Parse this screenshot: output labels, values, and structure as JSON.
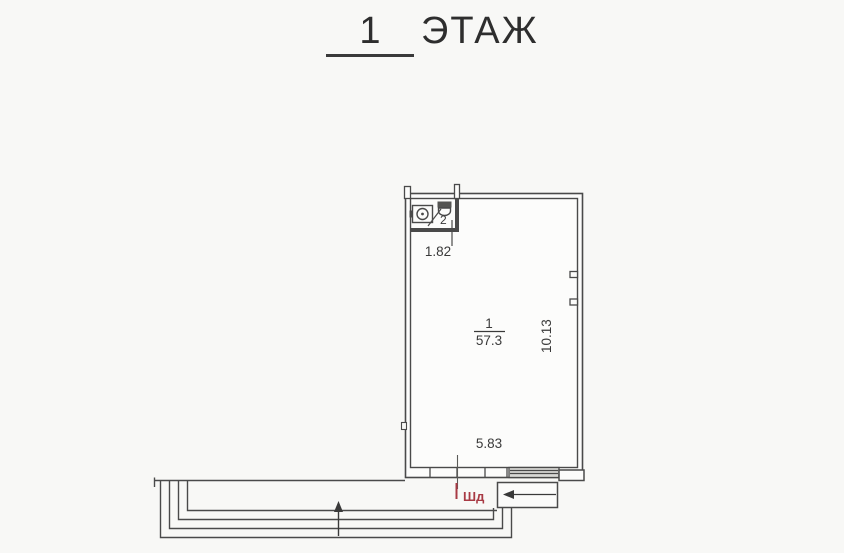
{
  "background": "#f8f8f6",
  "title": {
    "number": "1",
    "label": "ЭТАЖ"
  },
  "plan": {
    "room_number": "1",
    "room_area": "57.3",
    "width_dim": "5.83",
    "height_dim": "10.13",
    "bathroom_number": "2",
    "bathroom_width_dim": "1.82",
    "door_mark": "Шд"
  },
  "colors": {
    "line": "#4a4a4a",
    "red_mark": "#a83a44",
    "text": "#3a3a3a"
  }
}
